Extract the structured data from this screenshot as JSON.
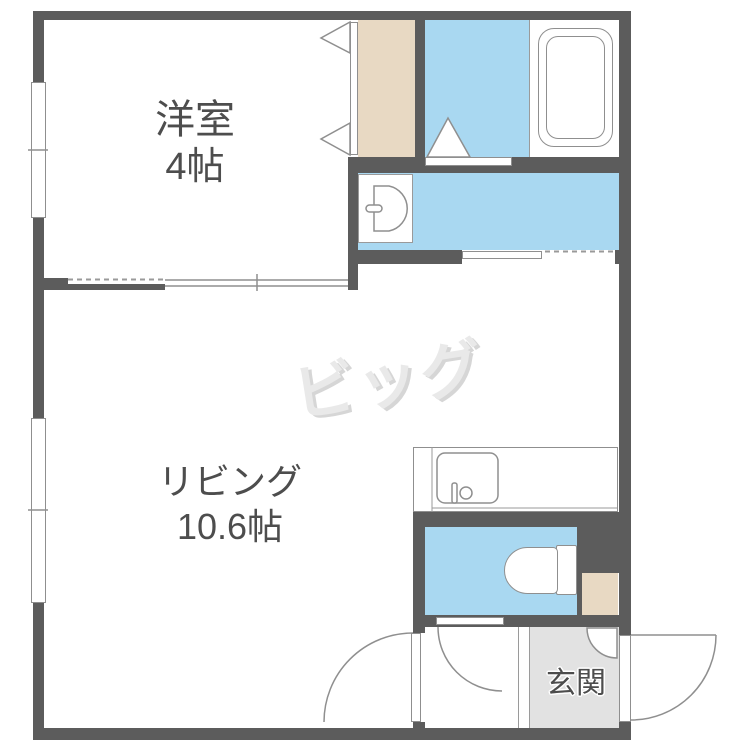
{
  "rooms": {
    "western": {
      "label": "洋室",
      "size": "4帖"
    },
    "living": {
      "label": "リビング",
      "size": "10.6帖"
    },
    "entrance": {
      "label": "玄関"
    }
  },
  "watermark": {
    "text": "ビッグ"
  },
  "colors": {
    "wall": "#5c5c5c",
    "water": "#a9d8f1",
    "tan": "#e8d9c3",
    "genkan": "#e2e2e2",
    "line": "#8f8f8f",
    "label": "#4d4d4d",
    "watermark": "#e9e9e9"
  },
  "fixtures": {
    "bathtub": "bathtub-icon",
    "toilet": "toilet-icon",
    "kitchen_sink": "kitchen-sink-icon",
    "washbasin": "washbasin-icon",
    "entrance_door": "swing-door-icon",
    "closet_door": "bifold-door-icon",
    "windows": "sliding-window-icon"
  }
}
